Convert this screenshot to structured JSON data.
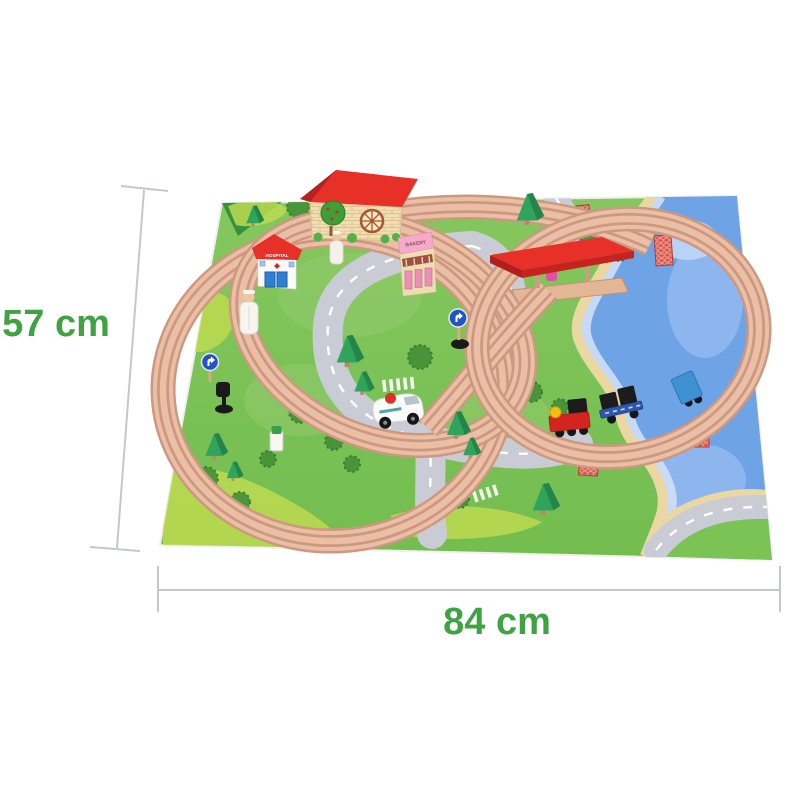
{
  "page": {
    "background": "#ffffff"
  },
  "annotations": {
    "height_label": "57 cm",
    "width_label": "84 cm",
    "text_color": "#3fa344",
    "line_color": "#c4c7cc"
  },
  "scene": {
    "subject": "wooden toy train set on printed play mat",
    "hospital_label": "HOSPITAL",
    "bakery_label": "BAKERY",
    "colors": {
      "mat_green": "#7cc356",
      "mat_light_green": "#bdda50",
      "painted_bush_green": "#459138",
      "water_blue": "#6ea3e6",
      "water_light_blue": "#8db6ee",
      "sand": "#ead7a2",
      "road_gray": "#c9ccd4",
      "road_marking": "#ffffff",
      "track_wood": "#eabfa6",
      "track_edge": "#cd9880",
      "roof_red": "#e63028",
      "bakery_pink": "#f4aac8",
      "pillar_brick_red": "#d9564a",
      "engine_red": "#d42420",
      "engine_dome_yellow": "#f2c011",
      "cargo_black": "#1c1c1e",
      "wagon_blue": "#2f58b0",
      "caboose_blue": "#3f92d2",
      "ambulance_white": "#fbfbf9",
      "ambulance_dot_red": "#e03028",
      "tree_green": "#2ea45c",
      "sign_blue": "#2153c4",
      "door_blue": "#2f7fd4"
    }
  }
}
